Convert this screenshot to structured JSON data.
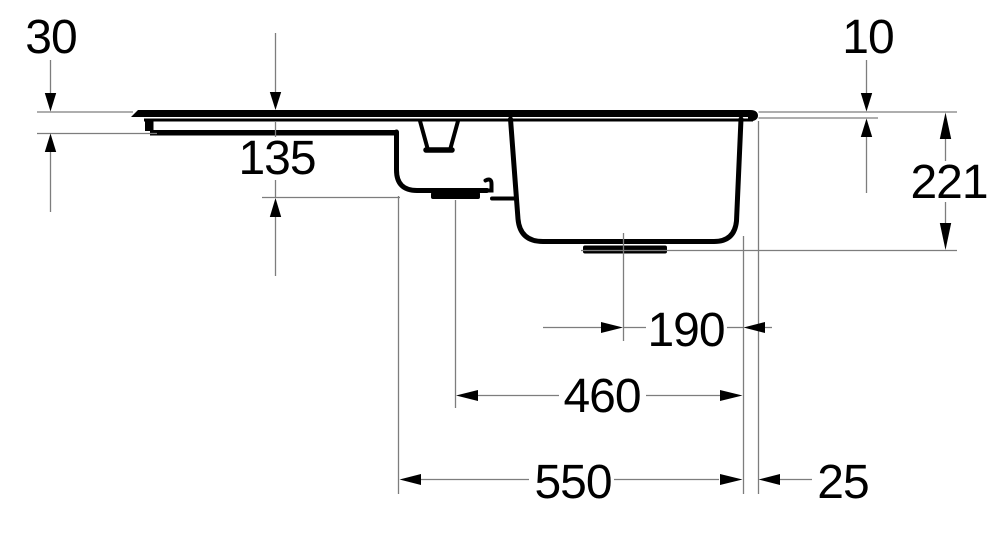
{
  "drawing": {
    "type": "technical-section-drawing",
    "subject": "Kitchen sink with drainboard, small bowl and main bowl - side section with dimensions",
    "units": "mm",
    "colors": {
      "outline": "#000000",
      "dimension_lines": "#7d7d7d",
      "text": "#000000",
      "background": "#ffffff"
    },
    "dimensions": [
      {
        "id": "left-edge-height",
        "label": "30",
        "axis": "vertical"
      },
      {
        "id": "rim-height-right",
        "label": "10",
        "axis": "vertical"
      },
      {
        "id": "small-bowl-depth",
        "label": "135",
        "axis": "vertical"
      },
      {
        "id": "main-bowl-depth",
        "label": "221",
        "axis": "vertical"
      },
      {
        "id": "main-drain-to-right-edge",
        "label": "190",
        "axis": "horizontal"
      },
      {
        "id": "small-drain-to-right-edge",
        "label": "460",
        "axis": "horizontal"
      },
      {
        "id": "bowl-span",
        "label": "550",
        "axis": "horizontal"
      },
      {
        "id": "right-edge-offset",
        "label": "25",
        "axis": "horizontal"
      }
    ]
  }
}
